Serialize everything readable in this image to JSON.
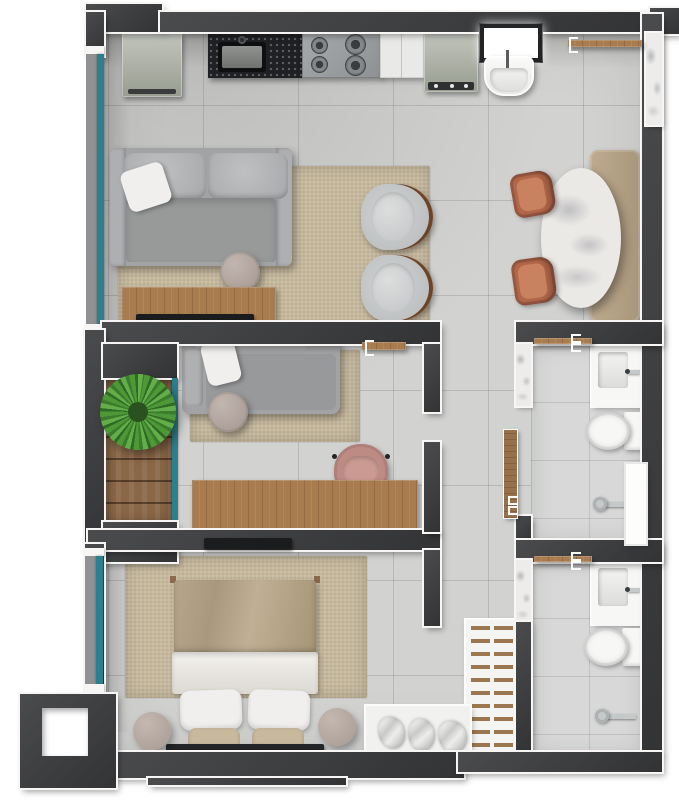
{
  "app": {
    "type": "floor-plan-render",
    "view": "top-down-3d",
    "canvas": {
      "w": 679,
      "h": 800
    }
  },
  "palette": {
    "bg": "#ffffff",
    "wall": "#3f4042",
    "trim": "#f7f6f4",
    "floor": "#d2d2d1",
    "bath_floor": "#d7d8d7",
    "rug": "#c6b99e",
    "wood": "#a97c50",
    "deck": "#8a6747",
    "marble": "#edecea",
    "glass": "#2c7f8d",
    "glass_frame": "#8f9193",
    "fixture_white": "#f7f7f6",
    "fridge": "#adb2a5",
    "granite": "#1f2023",
    "stove": "#9da0a2",
    "counter_white": "#e9e9e8",
    "sofa": "#a2a3a4",
    "pillow_white": "#f0efee",
    "table_round": "#b3a6a1",
    "armchair": "#c6c8c9",
    "armchair_wood": "#6e4426",
    "dining_bench": "#b4a084",
    "dining_chair": "#b3674a",
    "dining_table": "#ebe9e6",
    "chair_pink": "#bd8b84",
    "plant": "#4e9838",
    "plant_dark": "#2f6b24",
    "bed_blanket": "#b4a389",
    "bed_sheet": "#ece9e4",
    "bed_sham": "#c7b89e",
    "headboard": "#242526",
    "ladder_rung": "#9b7750",
    "tv": "#1b1c1d",
    "chrome": "#c6c9ca"
  },
  "rooms": {
    "kitchen": {
      "name": "Kitchen",
      "items": [
        "refrigerator",
        "granite counter with sink",
        "gas cooktop",
        "white counter",
        "washing machine",
        "window",
        "laundry tank"
      ]
    },
    "dining": {
      "name": "Dining area",
      "items": [
        "wall shelf",
        "oval marble table",
        "upholstered bench",
        "2 terracotta chairs",
        "marble accent wall"
      ]
    },
    "living": {
      "name": "Living room",
      "items": [
        "3-seat sofa",
        "area rug",
        "round coffee table",
        "TV console",
        "TV",
        "2 barrel armchairs"
      ]
    },
    "balcony": {
      "name": "Balcony",
      "items": [
        "wood deck",
        "potted palm",
        "glass wall"
      ]
    },
    "office": {
      "name": "Multipurpose room",
      "items": [
        "daybed",
        "area rug",
        "round side table",
        "desk",
        "desk chair",
        "wall shelf"
      ]
    },
    "hallway": {
      "name": "Hallway",
      "items": [
        "wood door leaf"
      ]
    },
    "bathroom1": {
      "name": "Bathroom 1",
      "items": [
        "towel rack",
        "vanity sink",
        "toilet",
        "shower",
        "glass panel",
        "marble strip"
      ]
    },
    "bathroom2": {
      "name": "Bathroom 2",
      "items": [
        "towel rack",
        "vanity sink",
        "toilet",
        "shower",
        "marble strip"
      ]
    },
    "bedroom": {
      "name": "Bedroom",
      "items": [
        "double bed",
        "area rug",
        "2 round nightstands",
        "wall TV",
        "glass window"
      ]
    },
    "closet": {
      "name": "Closet nook",
      "items": [
        "ladder rack",
        "white bench",
        "3 folded towels"
      ]
    },
    "shaft": {
      "name": "Service shaft",
      "items": [
        "open duct"
      ]
    }
  }
}
